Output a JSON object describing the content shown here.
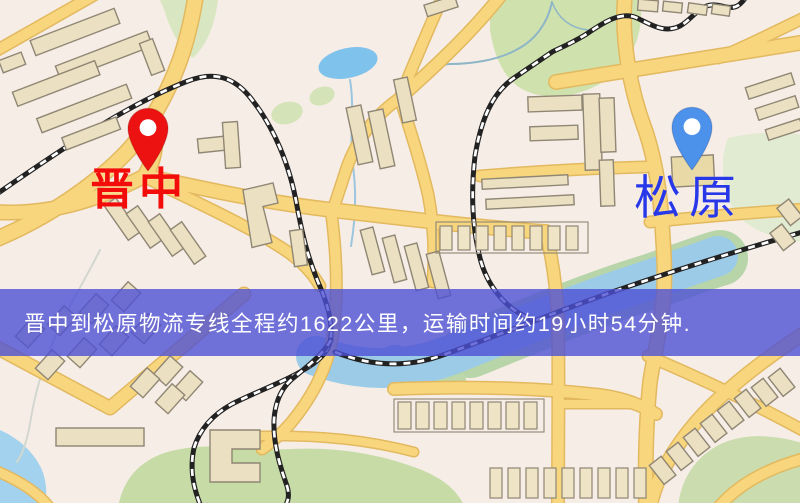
{
  "map": {
    "type": "city-street-map",
    "palette": {
      "background": "#f7f0e9",
      "road_fill": "#f7d67e",
      "road_casing": "#e3b95f",
      "building": "#ece0c2",
      "park": "#cfe2ad",
      "water": "#7fc2ec",
      "railway": "#222222"
    }
  },
  "markers": [
    {
      "id": "origin",
      "name": "晋中",
      "marker_color": "#ec1212",
      "label_color": "#f20d0a"
    },
    {
      "id": "destination",
      "name": "松原",
      "marker_color": "#4d92ea",
      "label_color": "#2837e8"
    }
  ],
  "route": {
    "origin": "晋中",
    "destination": "松原",
    "distance_km": 1622,
    "duration": "19小时54分钟"
  },
  "banner": {
    "text": "晋中到松原物流专线全程约1622公里，运输时间约19小时54分钟.",
    "background": "rgba(77,80,213,0.8)",
    "text_color": "#ffffff"
  }
}
